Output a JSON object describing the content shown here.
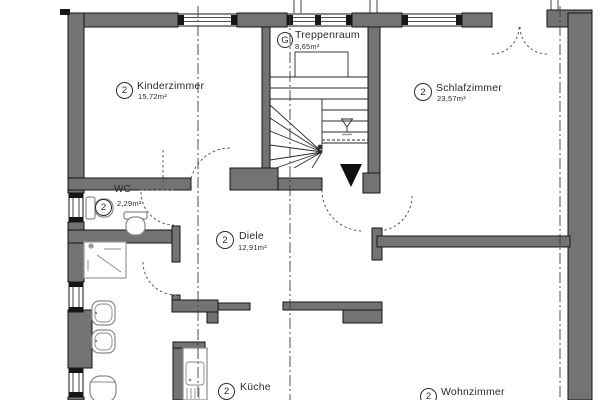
{
  "plan_title": "Apartment floor plan",
  "colors": {
    "wall": "#737373",
    "line": "#161616",
    "bg": "#ffffff",
    "text": "#2b2b2b"
  },
  "rooms": {
    "kinderzimmer": {
      "badge": "2",
      "name": "Kinderzimmer",
      "area": "15,72m²"
    },
    "treppenraum": {
      "badge": "G",
      "name": "Treppenraum",
      "area": "8,65m²"
    },
    "schlafzimmer": {
      "badge": "2",
      "name": "Schlafzimmer",
      "area": "23,57m²"
    },
    "wc": {
      "badge": "2",
      "name": "WC",
      "area": "2,29m²"
    },
    "diele": {
      "badge": "2",
      "name": "Diele",
      "area": "12,91m²"
    },
    "kueche": {
      "badge": "2",
      "name": "Küche"
    },
    "wohnzimmer": {
      "badge": "2",
      "name": "Wohnzimmer"
    }
  }
}
